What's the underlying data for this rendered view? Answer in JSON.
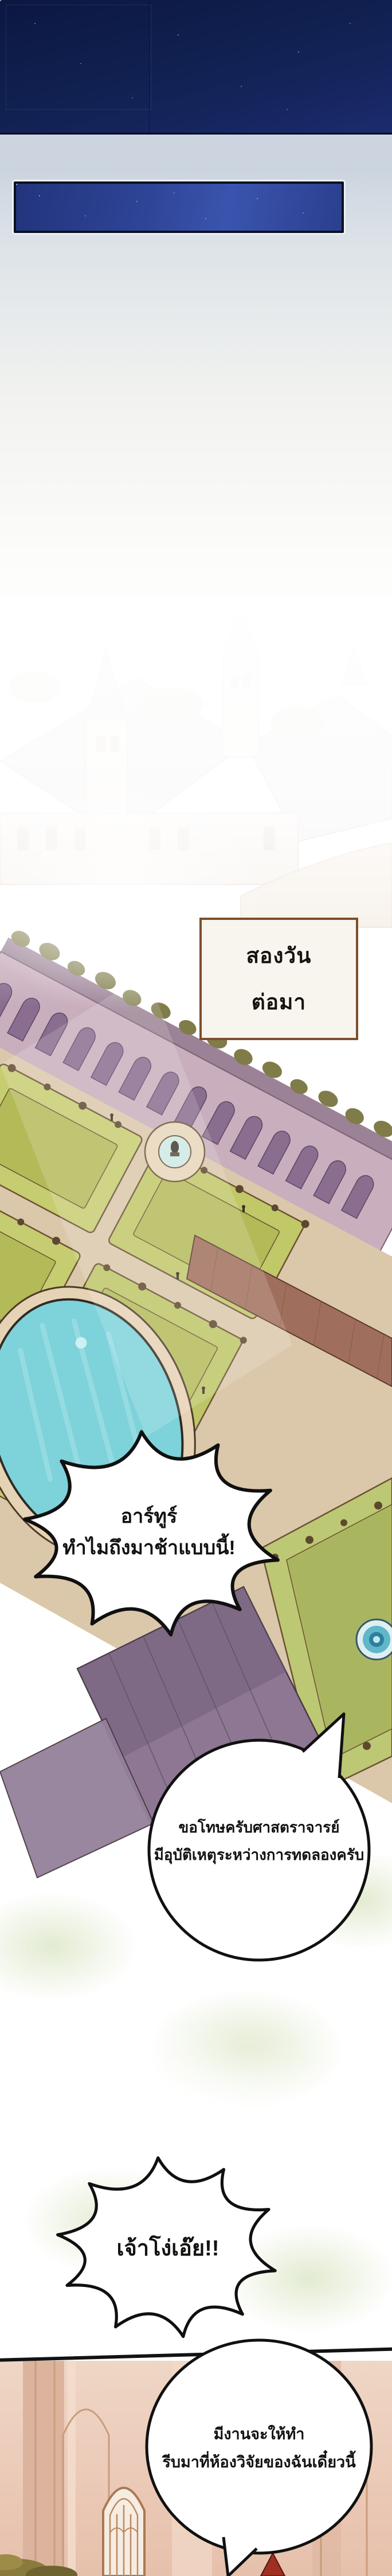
{
  "comic": {
    "panel_night": {
      "bg_top": "#0c1742",
      "bg_bottom": "#1b2c6e"
    },
    "panel_night_inset": {
      "bg": "#2e4496",
      "border": "#0b1020",
      "frame": "#edf1f6"
    },
    "caption_box": {
      "line1": "สองวัน",
      "line2": "ต่อมา",
      "border_color": "#7d4f2b",
      "bg": "#f8f5ee"
    },
    "bubbles": {
      "arthur_late": {
        "line1": "อาร์ทูร์",
        "line2": "ทำไมถึงมาช้าแบบนี้!"
      },
      "apology": {
        "line1": "ขอโทษครับศาสตราจารย์",
        "line2": "มีอุบัติเหตุระหว่างการทดลองครับ"
      },
      "idiot": {
        "line1": "เจ้าโง่เอ๊ย!!"
      },
      "task": {
        "line1": "มีงานจะให้ทำ",
        "line2": "รีบมาที่ห้องวิจัยของฉันเดี๋ยวนี้"
      }
    },
    "scene_colors": {
      "pool_water": "#7ed2da",
      "lawn": "#c6cc70",
      "garden_path": "#dbc7aa",
      "purple_roof": "#8d7792",
      "brick_road": "#a06e5c",
      "facade": "#c9aebd"
    }
  }
}
